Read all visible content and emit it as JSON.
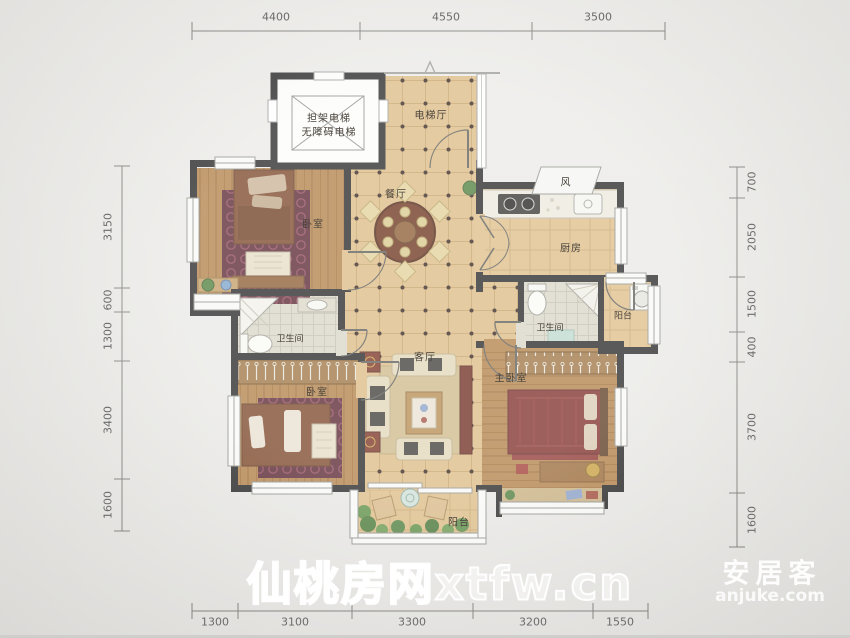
{
  "watermarks": {
    "site": "仙桃房网xtfw.cn",
    "brand": "安居客",
    "brand_url": "anjuke.com"
  },
  "dimensions": {
    "top": [
      "4400",
      "4550",
      "3500"
    ],
    "bottom": [
      "1300",
      "3100",
      "3300",
      "3200",
      "1550"
    ],
    "left": [
      "3150",
      "600",
      "1300",
      "3400",
      "1600"
    ],
    "right": [
      "700",
      "2050",
      "1500",
      "400",
      "3700",
      "1600"
    ]
  },
  "rooms": {
    "elevator_line1": "担架电梯",
    "elevator_line2": "无障碍电梯",
    "elevator_hall": "电梯厅",
    "dining": "餐厅",
    "bedroom_top": "卧室",
    "kitchen": "厨房",
    "flue": "风",
    "balcony_right": "阳台",
    "bath_right": "卫生间",
    "bath_left": "卫生间",
    "bedroom_bottom": "卧室",
    "living": "客厅",
    "master_bedroom": "主卧室",
    "balcony_bottom": "阳台"
  },
  "colors": {
    "wall": "#232323",
    "tile_floor": "#dcba82",
    "wood_floor": "#b17f46",
    "rug": "#56222e",
    "bed": "#7a4426",
    "background": "#e9e8e5",
    "dimension_text": "#6b6b6b",
    "watermark": "#ffffff"
  }
}
